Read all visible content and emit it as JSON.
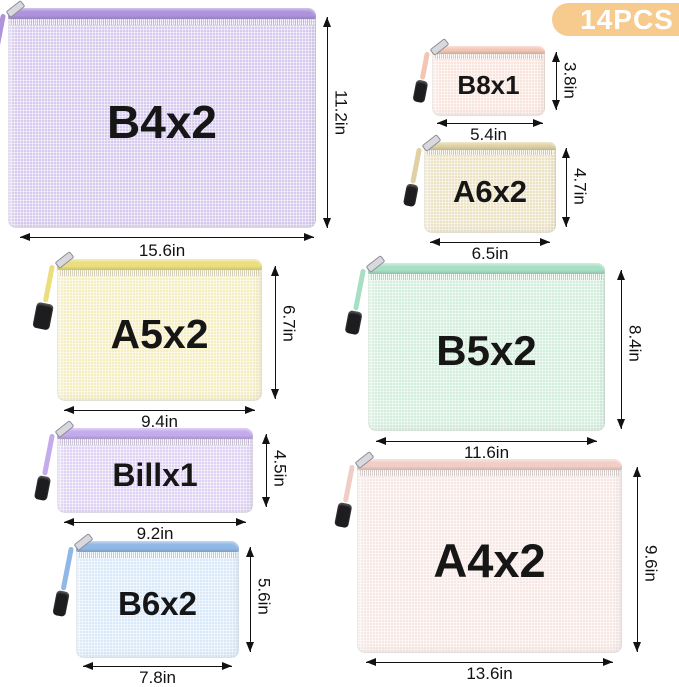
{
  "badge": {
    "label": "14PCS"
  },
  "bags": [
    {
      "name": "B4x2",
      "width": "15.6in",
      "height": "11.2in",
      "body_color": "#d6caee",
      "accent_color": "#ae93dc"
    },
    {
      "name": "B8x1",
      "width": "5.4in",
      "height": "3.8in",
      "body_color": "#f9e5dd",
      "accent_color": "#f3c5b3"
    },
    {
      "name": "A6x2",
      "width": "6.5in",
      "height": "4.7in",
      "body_color": "#ece2c4",
      "accent_color": "#dfd1a4"
    },
    {
      "name": "A5x2",
      "width": "9.4in",
      "height": "6.7in",
      "body_color": "#f4eec2",
      "accent_color": "#eade7d"
    },
    {
      "name": "B5x2",
      "width": "11.6in",
      "height": "8.4in",
      "body_color": "#d3eedd",
      "accent_color": "#a6dfc3"
    },
    {
      "name": "Billx1",
      "width": "9.2in",
      "height": "4.5in",
      "body_color": "#ded3f4",
      "accent_color": "#c4abeb"
    },
    {
      "name": "B6x2",
      "width": "7.8in",
      "height": "5.6in",
      "body_color": "#d9e9f9",
      "accent_color": "#8fb8e6"
    },
    {
      "name": "A4x2",
      "width": "13.6in",
      "height": "9.6in",
      "body_color": "#f7e8e5",
      "accent_color": "#f1cec5"
    }
  ],
  "colors": {
    "badge_bg": "#f7ca8e",
    "badge_text": "#ffffff",
    "annotation": "#121212",
    "pull_tab": "#1d1d1f"
  }
}
